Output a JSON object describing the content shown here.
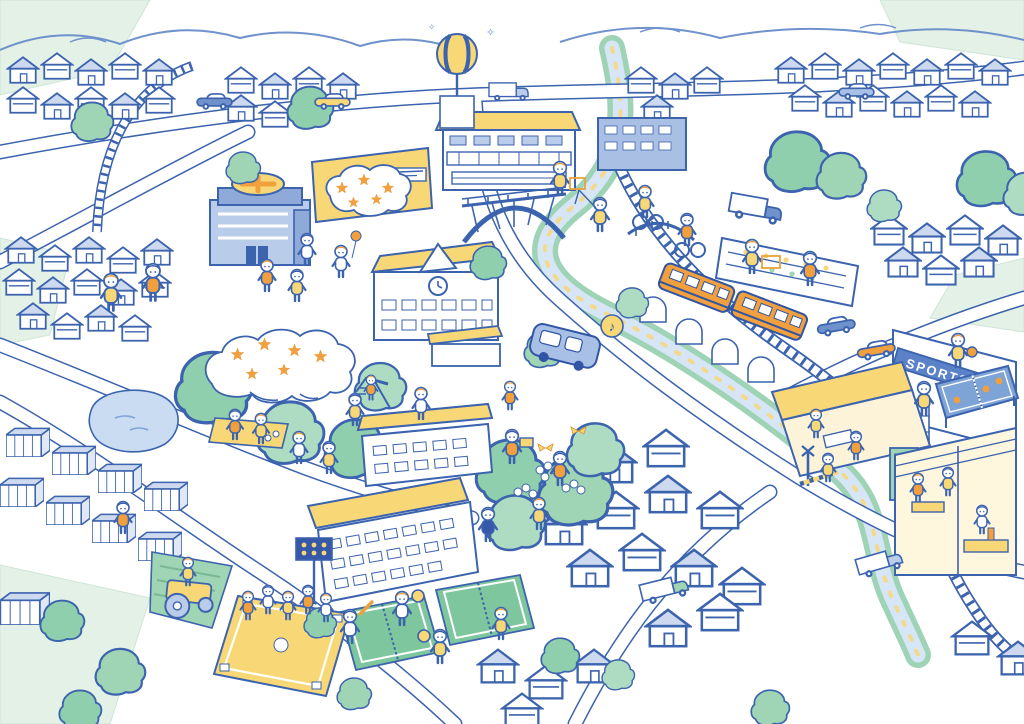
{
  "scene": {
    "type": "illustrated-town-map",
    "description": "Hand-drawn isometric illustration of a town: hospital, schools, station, shops, orange train, river, parks, sports fields and many people",
    "background": "#ffffff"
  },
  "signs": {
    "sports_banner": "SPORTS"
  },
  "icons": {
    "music_note": "♪",
    "sparkle": "✧"
  },
  "palette": {
    "outline_blue": "#3b63ae",
    "navy": "#2f55a4",
    "light_blue_fill": "#b9cce9",
    "pale_blue": "#ccd9ee",
    "mid_blue": "#6f92cc",
    "steel_blue": "#7ea3d7",
    "banner_blue": "#5b82c8",
    "yellow": "#f8d776",
    "orange": "#f2a03d",
    "green": "#8fcfae",
    "pale_green": "#e3f1e7",
    "water_blue": "#d7e6f6",
    "white": "#ffffff"
  },
  "landmarks": [
    {
      "id": "hospital",
      "name": "hospital-with-yellow-cross"
    },
    {
      "id": "station-mall",
      "name": "large-building-yellow-roof"
    },
    {
      "id": "shopping-building",
      "name": "yellow-shop-with-sign"
    },
    {
      "id": "clock-school",
      "name": "school-with-clock-gable"
    },
    {
      "id": "elementary-school",
      "name": "long-school-building"
    },
    {
      "id": "arch-bridge",
      "name": "blue-arch-bridge"
    },
    {
      "id": "ad-balloon",
      "name": "striped-ad-balloon"
    },
    {
      "id": "orange-train",
      "name": "orange-commuter-train"
    },
    {
      "id": "sports-shop",
      "name": "sports-shop-with-table-tennis"
    },
    {
      "id": "market",
      "name": "grocery-market"
    },
    {
      "id": "restaurant",
      "name": "open-front-restaurant"
    },
    {
      "id": "cafe",
      "name": "corner-cafe"
    },
    {
      "id": "park",
      "name": "blossom-park-with-picnic"
    },
    {
      "id": "pond",
      "name": "pond"
    },
    {
      "id": "tennis-courts",
      "name": "tennis-courts"
    },
    {
      "id": "baseball-field",
      "name": "baseball-diamond"
    },
    {
      "id": "farm",
      "name": "farm-with-tractor"
    },
    {
      "id": "warehouses",
      "name": "warehouse-district"
    },
    {
      "id": "river",
      "name": "river-with-green-banks"
    },
    {
      "id": "railway",
      "name": "railway-lines"
    }
  ]
}
